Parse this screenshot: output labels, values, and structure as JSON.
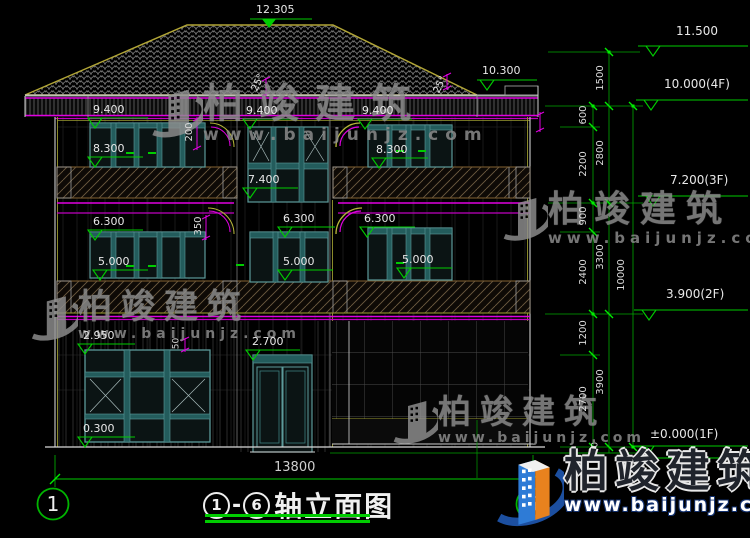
{
  "watermark": {
    "brand": "柏竣建筑",
    "url": "www.baijunjz.com"
  },
  "title": {
    "axis_from": "1",
    "axis_to": "6",
    "dash": "-",
    "text": "轴立面图"
  },
  "axes": {
    "left_bubble": "1",
    "right_bubble": "6"
  },
  "dims": {
    "overall_width": "13800",
    "d1500": "1500",
    "d600": "600",
    "d2200": "2200",
    "d900": "900",
    "d2400": "2400",
    "d1200": "1200",
    "d2700": "2700",
    "d150": "150",
    "d2800": "2800",
    "d3300": "3300",
    "d3900": "3900",
    "d10000": "10000",
    "d200": "200",
    "d350": "350",
    "d50": "50"
  },
  "levels": {
    "ridge": "12.305",
    "eave": "10.300",
    "l11500": "11.500",
    "l10000": "10.000(4F)",
    "l7200": "7.200(3F)",
    "l3900": "3.900(2F)",
    "l0000": "±0.000(1F)",
    "lm150": "0.150",
    "v9400": "9.400",
    "v8300": "8.300",
    "v7400": "7.400",
    "v6300": "6.300",
    "v5000": "5.000",
    "v2950": "2.950",
    "v2700": "2.700",
    "v0300": "0.300"
  },
  "angles": {
    "roof_slope": "25°"
  },
  "colors": {
    "dim_green": "#00cc00",
    "magenta": "#e000e0",
    "cad_yellow": "#a8a832",
    "frame_teal": "#5c9a9a",
    "line_white": "#d9d9d9",
    "brand_blue": "#1c4fa0",
    "brand_orange": "#e8821e"
  }
}
